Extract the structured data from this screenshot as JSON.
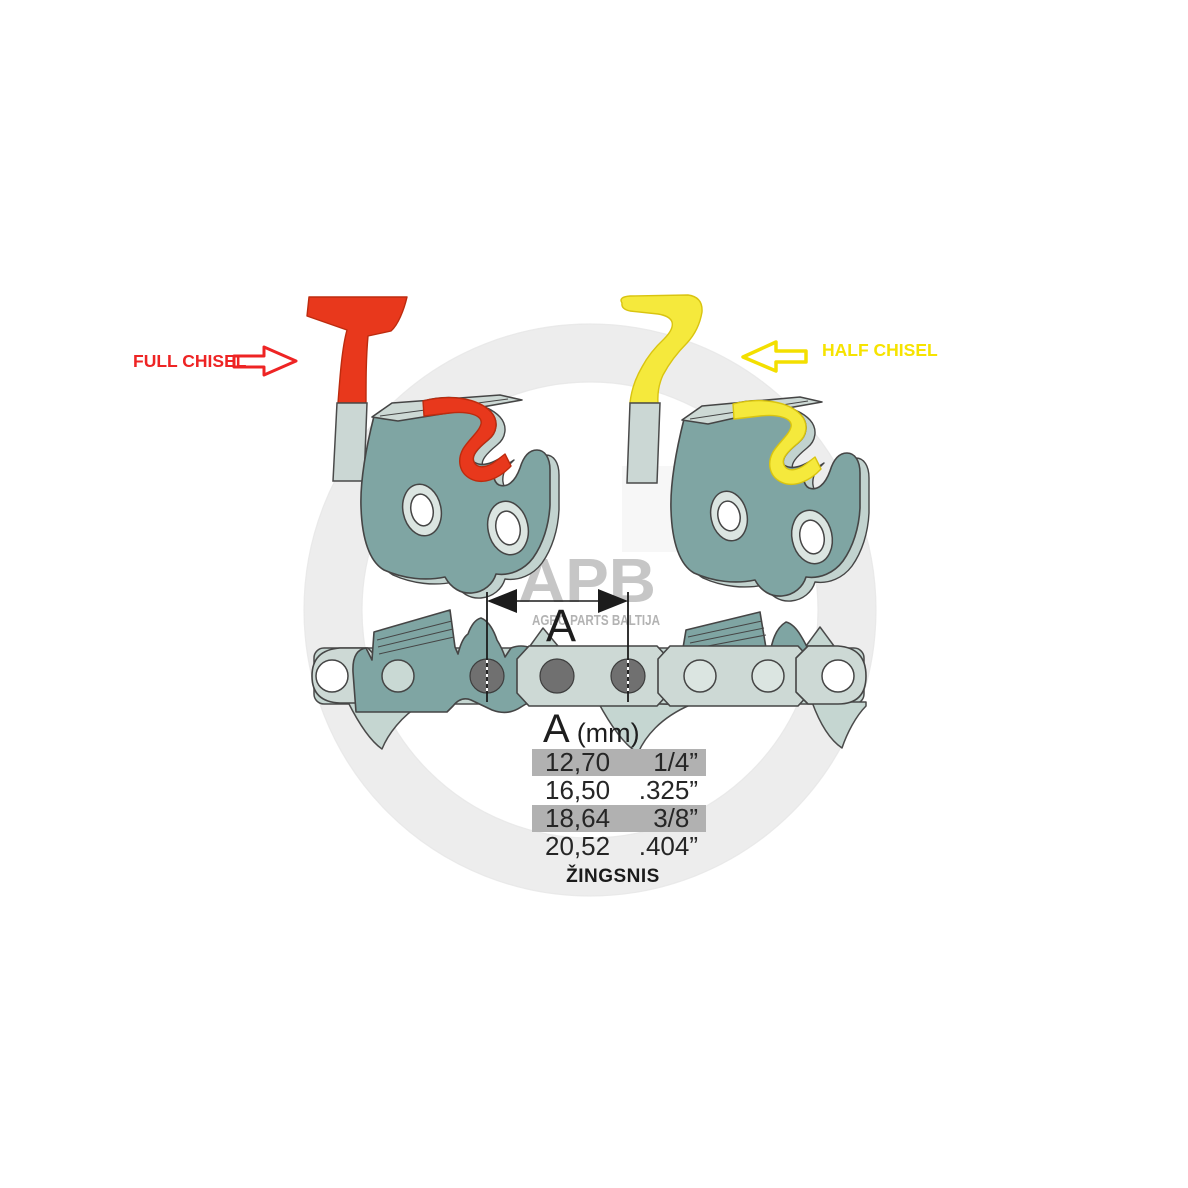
{
  "labels": {
    "full_chisel": "FULL CHISEL",
    "half_chisel": "HALF CHISEL",
    "pitch_caption": "ŽINGSNIS"
  },
  "measurement": {
    "letter": "A"
  },
  "watermark": {
    "letters": "APB",
    "subtitle": "AGRO PARTS BALTIJA"
  },
  "pitch_table": {
    "header_letter": "A",
    "header_unit": "(mm)",
    "rows": [
      {
        "mm": "12,70",
        "inch": "1/4”",
        "highlighted": true
      },
      {
        "mm": "16,50",
        "inch": ".325”",
        "highlighted": false
      },
      {
        "mm": "18,64",
        "inch": "3/8”",
        "highlighted": true
      },
      {
        "mm": "20,52",
        "inch": ".404”",
        "highlighted": false
      }
    ]
  },
  "colors": {
    "full_chisel_red": "#e8381c",
    "half_chisel_yellow": "#f5e93c",
    "label_red": "#ee2424",
    "label_yellow": "#f6e300",
    "cutter_teal": "#7fa5a3",
    "cutter_teal_light": "#c2d3cf",
    "link_plate_light": "#cdd9d5",
    "rivet_gray": "#707070",
    "table_row_gray": "#b1b1b1",
    "watermark_gray": "#ededed"
  }
}
